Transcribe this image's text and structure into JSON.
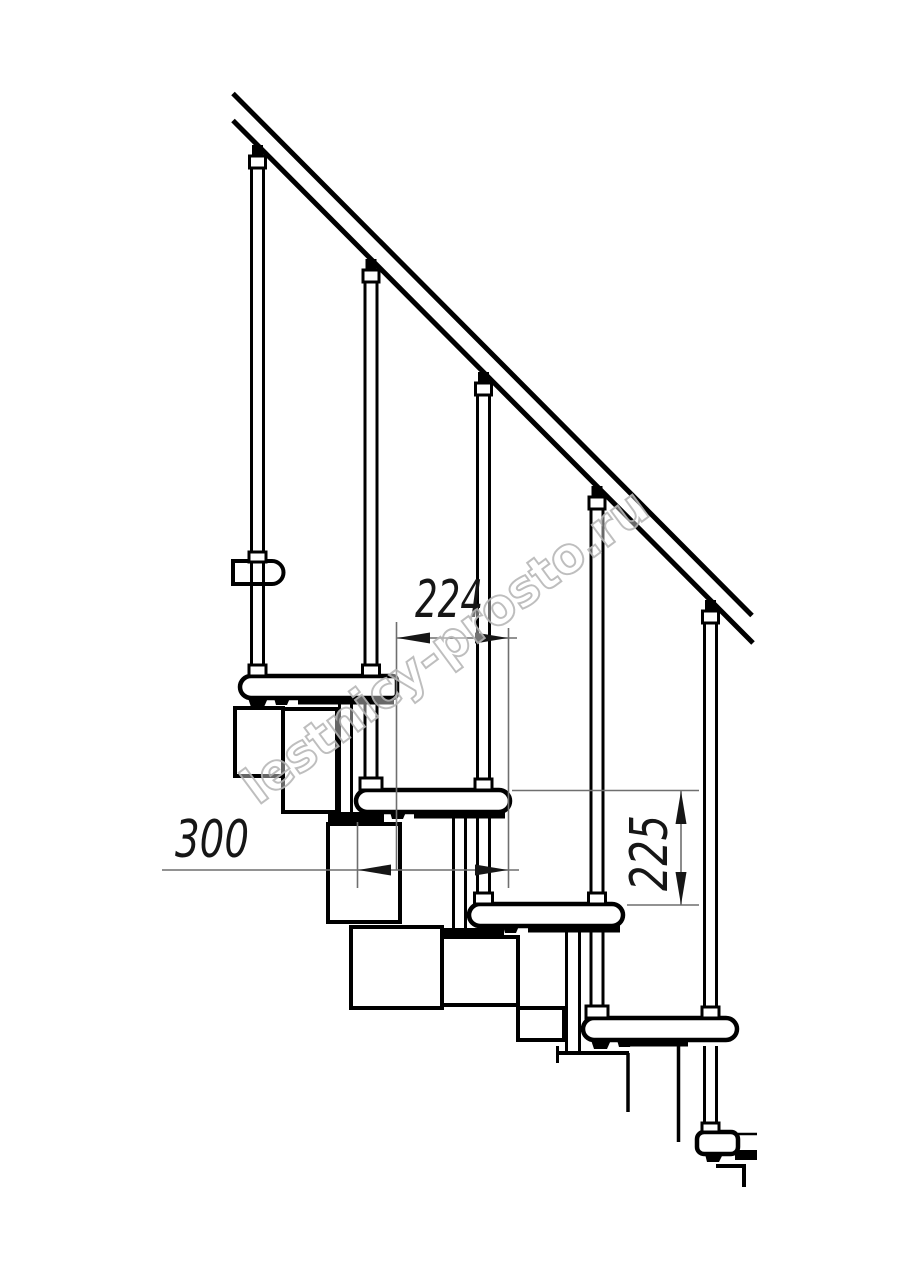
{
  "dimensions": {
    "d224": "224",
    "d300": "300",
    "d225": "225"
  },
  "watermark": {
    "text": "lestnicy-prosto.ru"
  },
  "colors": {
    "line": "#000000",
    "dimension_line": "#6f6f6f",
    "dimension_text": "#161616",
    "watermark": "#b8b8b8",
    "background": "#ffffff"
  }
}
